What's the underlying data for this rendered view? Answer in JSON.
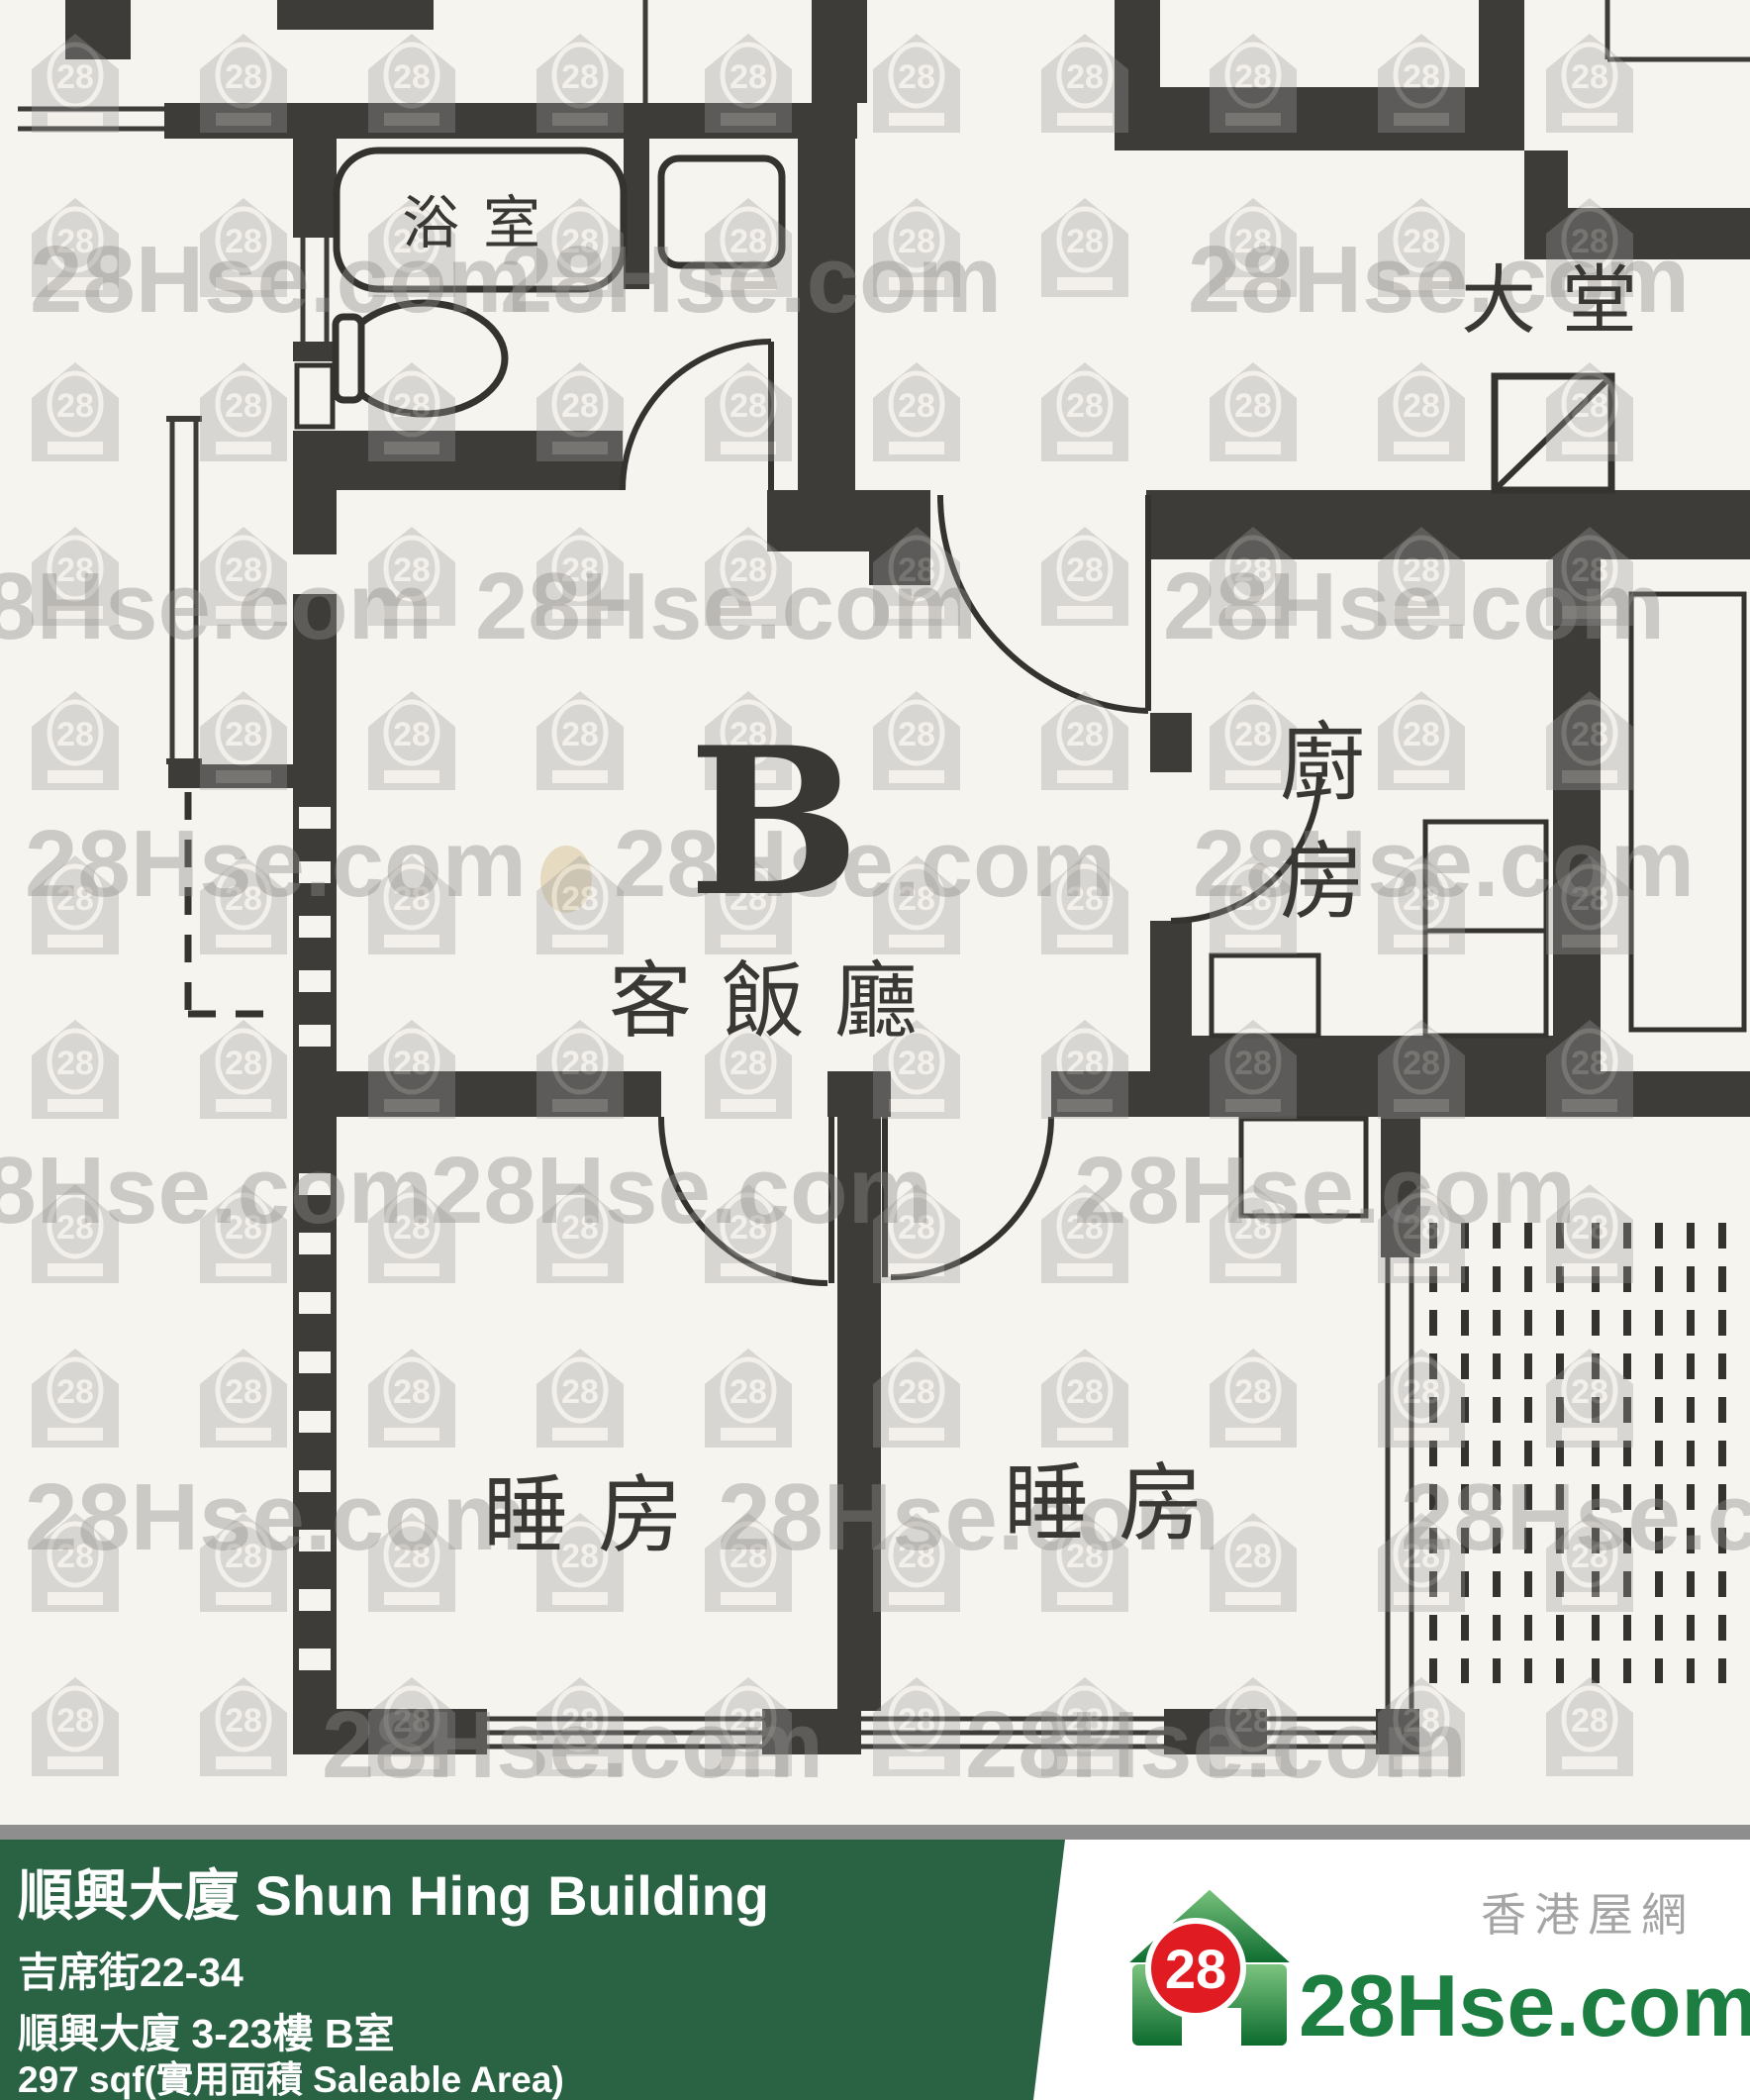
{
  "floorplan": {
    "unit_label": "B",
    "rooms": {
      "bathroom": "浴室",
      "lobby": "大堂",
      "kitchen_chars": [
        "廚",
        "房"
      ],
      "living_dining": "客飯廳",
      "bedroom_left": "睡房",
      "bedroom_right": "睡房"
    },
    "wall_color": "#3e3c39",
    "paper_color": "#f6f4ee"
  },
  "watermark": {
    "text": "28Hse.com",
    "badge": "28"
  },
  "footer": {
    "title": "順興大廈 Shun Hing Building",
    "address_line": "吉席街22-34",
    "unit_line": "順興大廈 3-23樓 B室",
    "area_line": "297 sqf(實用面積 Saleable Area)",
    "bar_color": "#2a6244"
  },
  "logo": {
    "badge": "28",
    "site_name": "28Hse.com",
    "tagline": "香港屋網"
  }
}
